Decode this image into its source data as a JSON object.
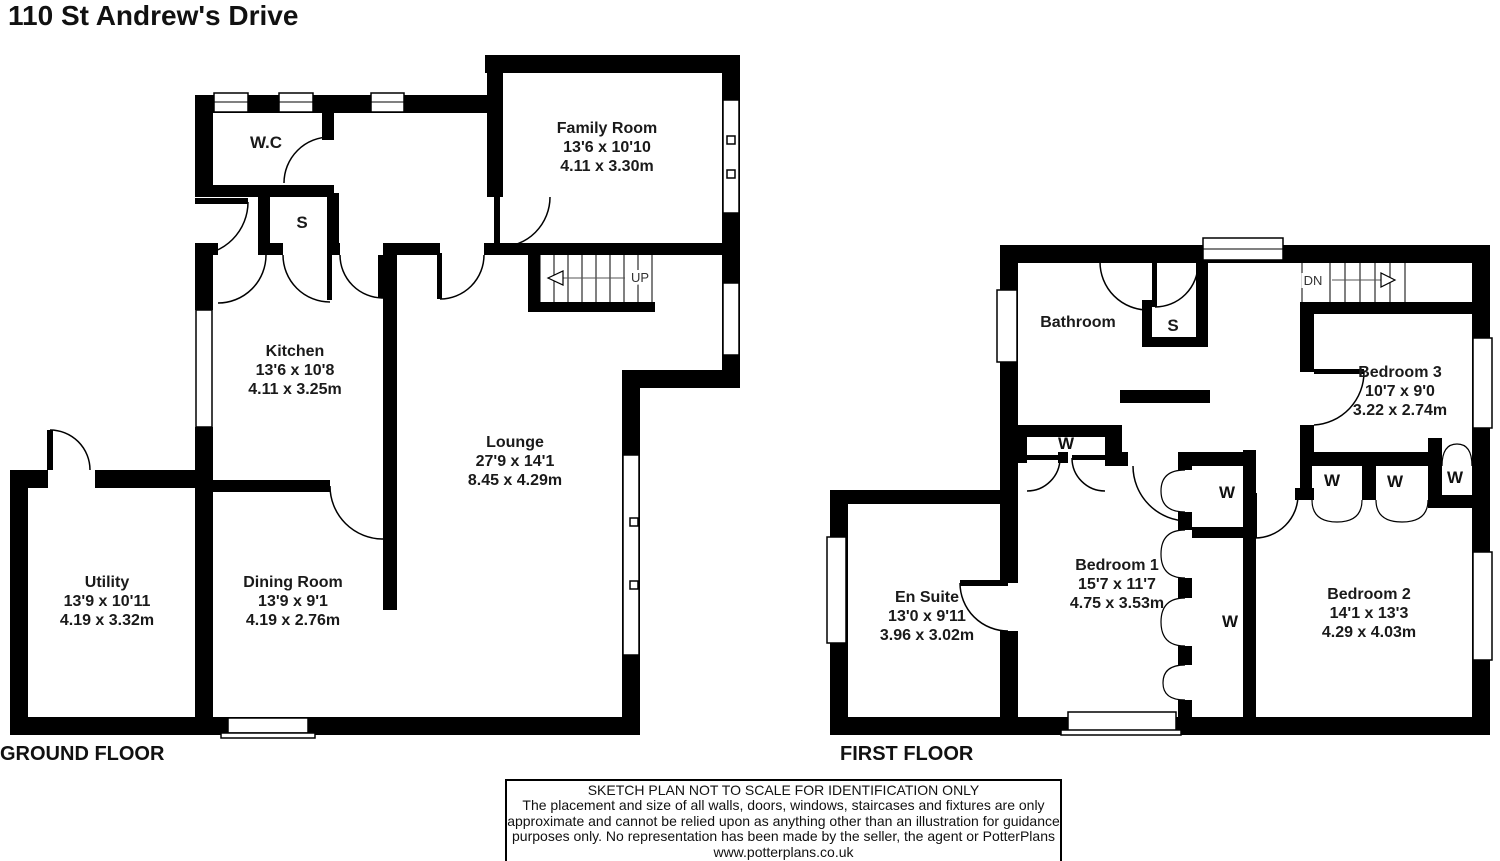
{
  "title": "110 St Andrew's Drive",
  "ground_floor": {
    "label": "GROUND FLOOR",
    "stair_label": "UP",
    "rooms": {
      "wc": {
        "name": "W.C"
      },
      "cupboard": {
        "name": "S"
      },
      "family_room": {
        "name": "Family Room",
        "size_ft": "13'6 x 10'10",
        "size_m": "4.11 x 3.30m"
      },
      "kitchen": {
        "name": "Kitchen",
        "size_ft": "13'6 x 10'8",
        "size_m": "4.11 x 3.25m"
      },
      "lounge": {
        "name": "Lounge",
        "size_ft": "27'9 x 14'1",
        "size_m": "8.45 x 4.29m"
      },
      "utility": {
        "name": "Utility",
        "size_ft": "13'9 x 10'11",
        "size_m": "4.19 x 3.32m"
      },
      "dining_room": {
        "name": "Dining Room",
        "size_ft": "13'9 x 9'1",
        "size_m": "4.19 x 2.76m"
      }
    }
  },
  "first_floor": {
    "label": "FIRST FLOOR",
    "stair_label": "DN",
    "wardrobe_label": "W",
    "rooms": {
      "bathroom": {
        "name": "Bathroom"
      },
      "cupboard": {
        "name": "S"
      },
      "bedroom_1": {
        "name": "Bedroom 1",
        "size_ft": "15'7 x 11'7",
        "size_m": "4.75 x 3.53m"
      },
      "bedroom_2": {
        "name": "Bedroom 2",
        "size_ft": "14'1 x 13'3",
        "size_m": "4.29 x 4.03m"
      },
      "bedroom_3": {
        "name": "Bedroom 3",
        "size_ft": "10'7 x 9'0",
        "size_m": "3.22 x 2.74m"
      },
      "en_suite": {
        "name": "En Suite",
        "size_ft": "13'0 x 9'11",
        "size_m": "3.96 x 3.02m"
      }
    }
  },
  "disclaimer": {
    "line1": "SKETCH PLAN NOT TO SCALE FOR IDENTIFICATION ONLY",
    "line2": "The placement and size of all walls, doors, windows, staircases and fixtures are only",
    "line3": "approximate and cannot be relied upon as anything other than an illustration for guidance",
    "line4": "purposes only. No representation has been made by the seller, the agent or PotterPlans",
    "line5": "www.potterplans.co.uk"
  },
  "colors": {
    "wall": "#000000",
    "background": "#ffffff"
  }
}
